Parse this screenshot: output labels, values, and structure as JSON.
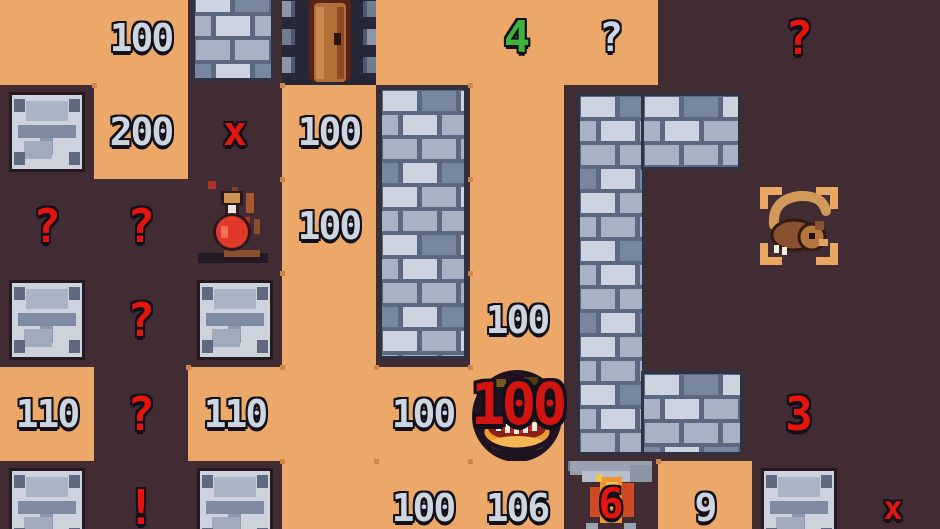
{
  "palette": {
    "floor": "#eba868",
    "floor_dot": "#cf8648",
    "dark_bg": "#422c34",
    "wall_light": "#ccd4e0",
    "wall_mid": "#a7b2c4",
    "wall_dark": "#78869f",
    "wall_mortar": "#5c6880",
    "wall_border": "#2e3343",
    "silver_text": "#ccd5e0",
    "red_text": "#e3150d",
    "big_red_text": "#d21410",
    "green_text": "#3db33d",
    "door_bg": "#262737",
    "door_wood": "#b26f3a",
    "potion_red": "#e0392a",
    "flame_orange": "#ef9430",
    "flame_red": "#cf4a22"
  },
  "board": {
    "cols": 10,
    "rows": 6,
    "cell_px": 94,
    "offset_y": -9,
    "cells": [
      {
        "r": 0,
        "c": 0,
        "bg": "F"
      },
      {
        "r": 0,
        "c": 1,
        "bg": "F",
        "label": "100",
        "style": "silver",
        "name": "number-100"
      },
      {
        "r": 0,
        "c": 2,
        "bg": "D",
        "name": "brick-wall-cell"
      },
      {
        "r": 0,
        "c": 3,
        "bg": "D",
        "tile": "door",
        "name": "door"
      },
      {
        "r": 0,
        "c": 4,
        "bg": "F"
      },
      {
        "r": 0,
        "c": 5,
        "bg": "F",
        "label": "4",
        "style": "green",
        "name": "green-number-4"
      },
      {
        "r": 0,
        "c": 6,
        "bg": "F",
        "label": "?",
        "style": "silver-q",
        "name": "silver-question-mark"
      },
      {
        "r": 0,
        "c": 7,
        "bg": "D"
      },
      {
        "r": 0,
        "c": 8,
        "bg": "D",
        "label": "?",
        "style": "red-q",
        "name": "red-question-mark"
      },
      {
        "r": 0,
        "c": 9,
        "bg": "D"
      },
      {
        "r": 1,
        "c": 0,
        "bg": "D",
        "tile": "stone",
        "name": "stone-block"
      },
      {
        "r": 1,
        "c": 1,
        "bg": "F",
        "label": "200",
        "style": "silver",
        "name": "number-200"
      },
      {
        "r": 1,
        "c": 2,
        "bg": "D",
        "label": "x",
        "style": "red-x",
        "name": "red-cross"
      },
      {
        "r": 1,
        "c": 3,
        "bg": "F",
        "label": "100",
        "style": "silver",
        "name": "number-100"
      },
      {
        "r": 1,
        "c": 4,
        "bg": "D"
      },
      {
        "r": 1,
        "c": 5,
        "bg": "F"
      },
      {
        "r": 1,
        "c": 6,
        "bg": "D"
      },
      {
        "r": 1,
        "c": 7,
        "bg": "D"
      },
      {
        "r": 1,
        "c": 8,
        "bg": "D"
      },
      {
        "r": 1,
        "c": 9,
        "bg": "D"
      },
      {
        "r": 2,
        "c": 0,
        "bg": "D",
        "label": "?",
        "style": "red-q",
        "name": "red-question-mark"
      },
      {
        "r": 2,
        "c": 1,
        "bg": "D",
        "label": "?",
        "style": "red-q",
        "name": "red-question-mark"
      },
      {
        "r": 2,
        "c": 2,
        "bg": "D",
        "tile": "potion",
        "name": "potion"
      },
      {
        "r": 2,
        "c": 3,
        "bg": "F",
        "label": "100",
        "style": "silver",
        "name": "number-100"
      },
      {
        "r": 2,
        "c": 4,
        "bg": "D"
      },
      {
        "r": 2,
        "c": 5,
        "bg": "F"
      },
      {
        "r": 2,
        "c": 6,
        "bg": "D"
      },
      {
        "r": 2,
        "c": 7,
        "bg": "D"
      },
      {
        "r": 2,
        "c": 8,
        "bg": "D",
        "tile": "rat",
        "name": "rat-monster"
      },
      {
        "r": 2,
        "c": 9,
        "bg": "D"
      },
      {
        "r": 3,
        "c": 0,
        "bg": "D",
        "tile": "stone",
        "name": "stone-block"
      },
      {
        "r": 3,
        "c": 1,
        "bg": "D",
        "label": "?",
        "style": "red-q",
        "name": "red-question-mark"
      },
      {
        "r": 3,
        "c": 2,
        "bg": "D",
        "tile": "stone",
        "name": "stone-block"
      },
      {
        "r": 3,
        "c": 3,
        "bg": "F"
      },
      {
        "r": 3,
        "c": 4,
        "bg": "D"
      },
      {
        "r": 3,
        "c": 5,
        "bg": "F",
        "label": "100",
        "style": "silver",
        "name": "number-100"
      },
      {
        "r": 3,
        "c": 6,
        "bg": "D"
      },
      {
        "r": 3,
        "c": 7,
        "bg": "D"
      },
      {
        "r": 3,
        "c": 8,
        "bg": "D"
      },
      {
        "r": 3,
        "c": 9,
        "bg": "D"
      },
      {
        "r": 4,
        "c": 0,
        "bg": "F",
        "label": "110",
        "style": "silver",
        "name": "number-110"
      },
      {
        "r": 4,
        "c": 1,
        "bg": "D",
        "label": "?",
        "style": "red-q",
        "name": "red-question-mark"
      },
      {
        "r": 4,
        "c": 2,
        "bg": "F",
        "label": "110",
        "style": "silver",
        "name": "number-110"
      },
      {
        "r": 4,
        "c": 3,
        "bg": "F"
      },
      {
        "r": 4,
        "c": 4,
        "bg": "F",
        "label": "100",
        "style": "silver",
        "name": "number-100"
      },
      {
        "r": 4,
        "c": 5,
        "bg": "F",
        "tile": "maw",
        "label": "100",
        "style": "big-red",
        "name": "maw-monster-hp"
      },
      {
        "r": 4,
        "c": 6,
        "bg": "D"
      },
      {
        "r": 4,
        "c": 7,
        "bg": "D"
      },
      {
        "r": 4,
        "c": 8,
        "bg": "D",
        "label": "3",
        "style": "red-num",
        "name": "red-number-3"
      },
      {
        "r": 4,
        "c": 9,
        "bg": "D"
      },
      {
        "r": 5,
        "c": 0,
        "bg": "D",
        "tile": "stone",
        "name": "stone-block"
      },
      {
        "r": 5,
        "c": 1,
        "bg": "D",
        "label": "!",
        "style": "red-bang",
        "name": "red-exclamation"
      },
      {
        "r": 5,
        "c": 2,
        "bg": "D",
        "tile": "stone",
        "name": "stone-block"
      },
      {
        "r": 5,
        "c": 3,
        "bg": "F"
      },
      {
        "r": 5,
        "c": 4,
        "bg": "F",
        "label": "100",
        "style": "silver",
        "name": "number-100"
      },
      {
        "r": 5,
        "c": 5,
        "bg": "F",
        "label": "106",
        "style": "silver",
        "name": "number-106"
      },
      {
        "r": 5,
        "c": 6,
        "bg": "D",
        "tile": "flame",
        "label": "6",
        "style": "red-six",
        "name": "flame-monster-hp"
      },
      {
        "r": 5,
        "c": 7,
        "bg": "F",
        "label": "9",
        "style": "silver",
        "name": "number-9"
      },
      {
        "r": 5,
        "c": 8,
        "bg": "D",
        "tile": "stone",
        "name": "stone-block"
      },
      {
        "r": 5,
        "c": 9,
        "bg": "D",
        "label": "x",
        "style": "red-x-sm",
        "name": "red-cross-small"
      }
    ],
    "walls": [
      {
        "name": "brick-tile",
        "x": 192,
        "y": -12,
        "w": 82,
        "h": 93
      },
      {
        "name": "wall-left-vertical",
        "x": 379,
        "y": 87,
        "w": 88,
        "h": 272
      },
      {
        "name": "wall-c-vertical",
        "x": 577,
        "y": 93,
        "w": 68,
        "h": 362
      },
      {
        "name": "wall-c-top",
        "x": 641,
        "y": 93,
        "w": 100,
        "h": 77
      },
      {
        "name": "wall-c-bottom",
        "x": 641,
        "y": 371,
        "w": 102,
        "h": 84
      }
    ]
  }
}
